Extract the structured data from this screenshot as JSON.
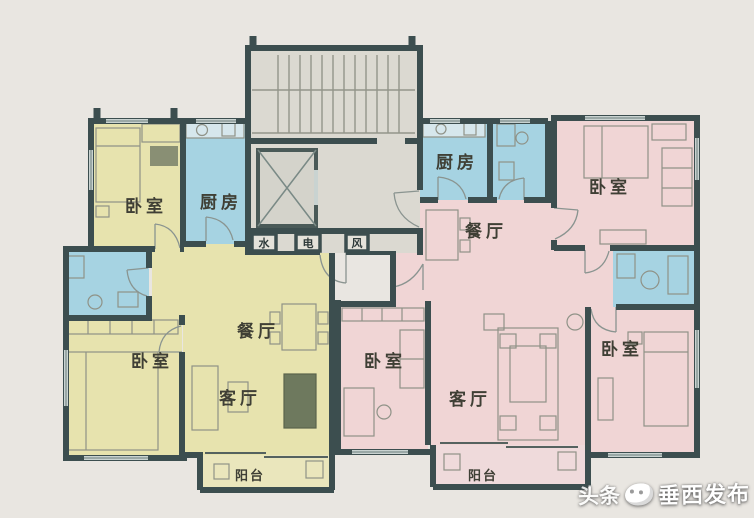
{
  "plan": {
    "left_unit": {
      "bedroom_top": "卧室",
      "kitchen": "厨房",
      "bedroom_main": "卧室",
      "dining": "餐厅",
      "living": "客厅",
      "balcony": "阳台"
    },
    "right_unit": {
      "kitchen": "厨房",
      "dining": "餐厅",
      "bedroom_top": "卧室",
      "bedroom_middle": "卧室",
      "bedroom_bottom": "卧室",
      "living": "客厅",
      "balcony": "阳台"
    },
    "core": {
      "shafts": [
        "水",
        "电",
        "风"
      ]
    }
  },
  "watermark": {
    "brand": "头条",
    "publisher": "垂西发布"
  },
  "colors": {
    "background": "#e9e6e1",
    "yellow_unit": "#e7e3ae",
    "balcony_yellow": "#eae6bc",
    "pink_unit": "#f0d5d5",
    "balcony_pink": "#efdadb",
    "blue_room": "#a6d3e2",
    "core": "#dbd9d1",
    "wall": "#3c4e4f",
    "label": "#3f3f35"
  }
}
